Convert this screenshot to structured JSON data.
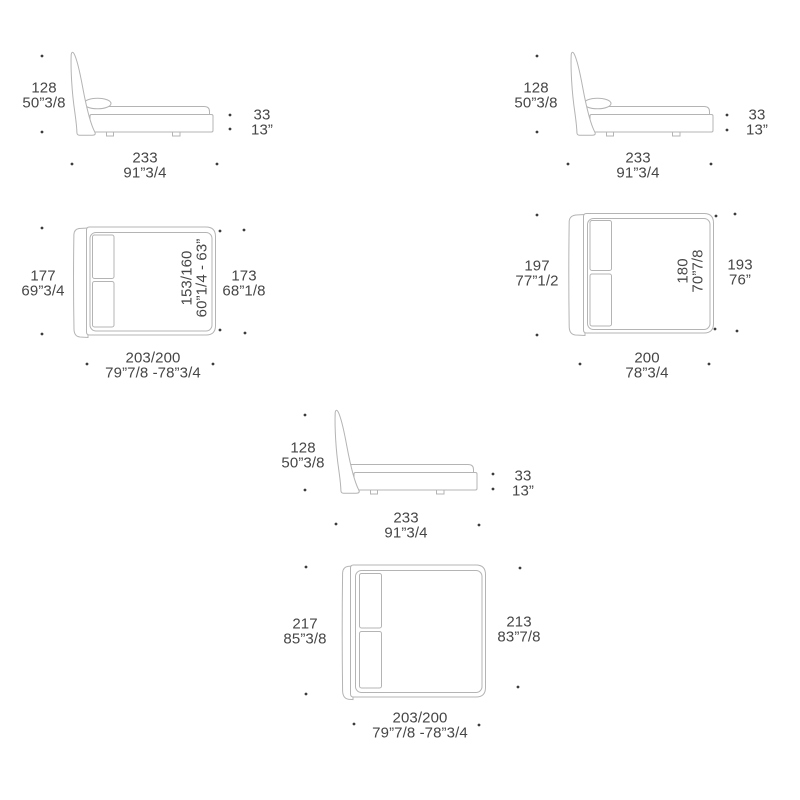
{
  "canvas": {
    "bg": "#ffffff",
    "line_color": "#b4b4b4",
    "text_color": "#464646",
    "dot_color": "#3c3c3c"
  },
  "figures": {
    "side_top_left": {
      "view": "bed side view",
      "height_cm": "128",
      "height_in": "50”3/8",
      "base_cm": "33",
      "base_in": "13”",
      "length_cm": "233",
      "length_in": "91”3/4"
    },
    "side_top_right": {
      "view": "bed side view",
      "height_cm": "128",
      "height_in": "50”3/8",
      "base_cm": "33",
      "base_in": "13”",
      "length_cm": "233",
      "length_in": "91”3/4"
    },
    "plan_mid_left": {
      "view": "bed top view",
      "width_total_cm": "177",
      "width_total_in": "69”3/4",
      "width_frame_cm": "173",
      "width_frame_in": "68”1/8",
      "mattress_cm": "153/160",
      "mattress_in": "60”1/4 - 63”",
      "length_cm": "203/200",
      "length_in": "79”7/8 -78”3/4"
    },
    "plan_mid_right": {
      "view": "bed top view",
      "width_total_cm": "197",
      "width_total_in": "77”1/2",
      "width_frame_cm": "193",
      "width_frame_in": "76”",
      "mattress_cm": "180",
      "mattress_in": "70”7/8",
      "length_cm": "200",
      "length_in": "78”3/4"
    },
    "side_bottom": {
      "view": "bed side view",
      "height_cm": "128",
      "height_in": "50”3/8",
      "base_cm": "33",
      "base_in": "13”",
      "length_cm": "233",
      "length_in": "91”3/4"
    },
    "plan_bottom": {
      "view": "bed top view",
      "width_total_cm": "217",
      "width_total_in": "85”3/8",
      "width_frame_cm": "213",
      "width_frame_in": "83”7/8",
      "length_cm": "203/200",
      "length_in": "79”7/8 -78”3/4"
    }
  }
}
